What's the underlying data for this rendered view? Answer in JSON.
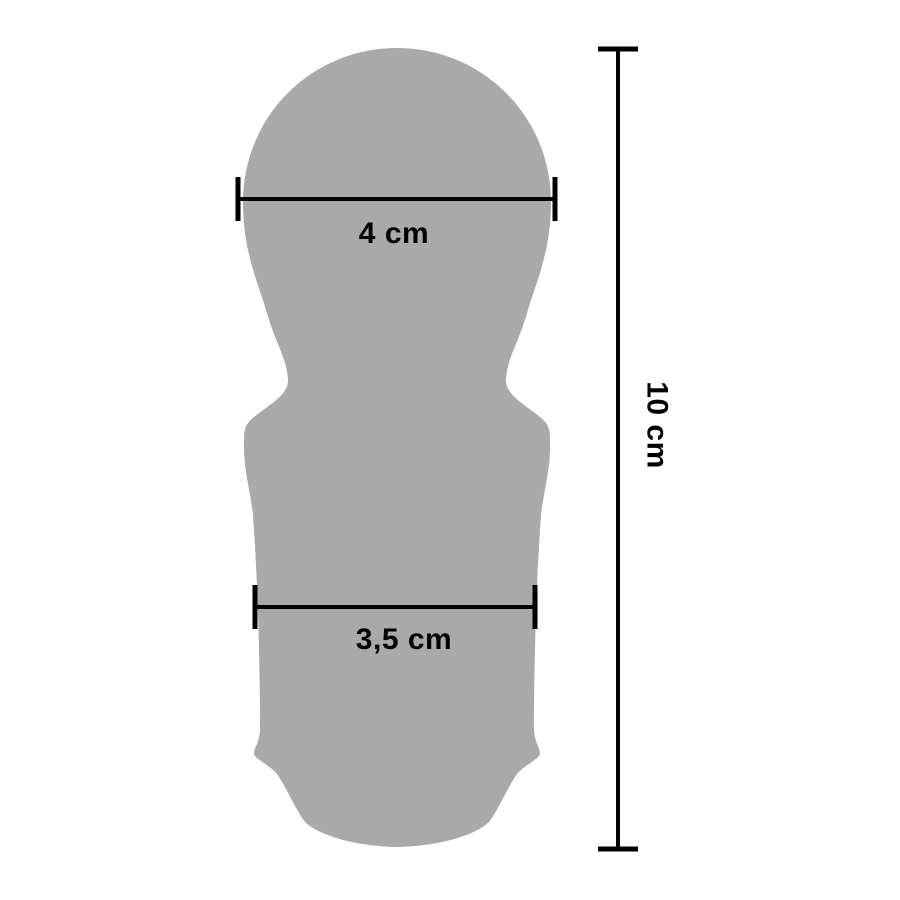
{
  "diagram": {
    "kind": "product-dimension-diagram",
    "background": "#ffffff"
  },
  "colors": {
    "shape": "#a9a9a9",
    "line": "#000000"
  },
  "measurements": {
    "head_width": {
      "label": "4 cm"
    },
    "body_width": {
      "label": "3,5 cm"
    },
    "total_height": {
      "label": "10 cm"
    }
  }
}
